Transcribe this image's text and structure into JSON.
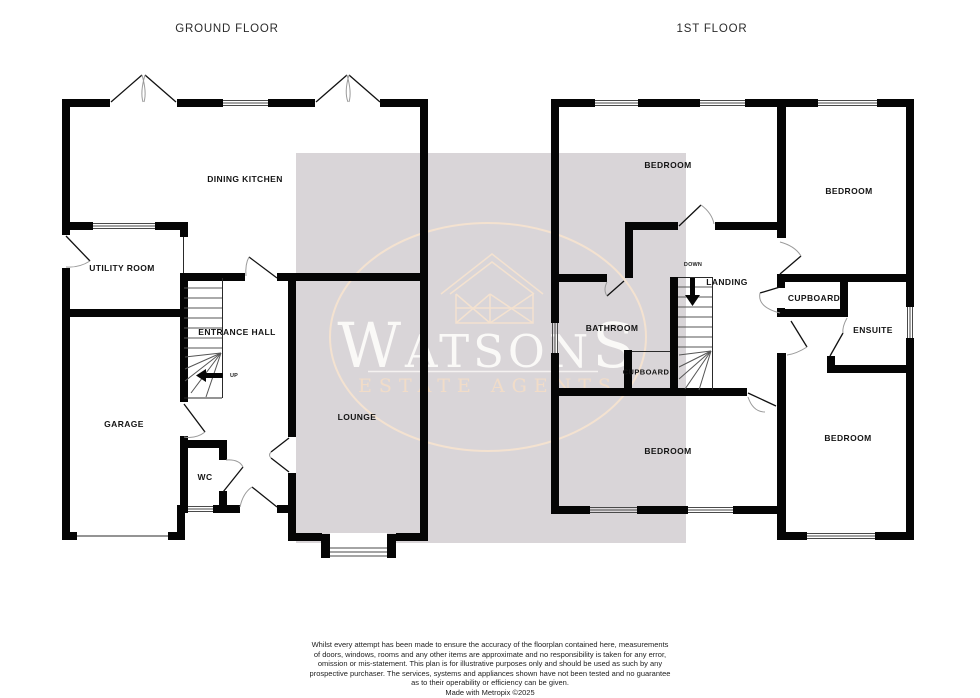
{
  "titles": {
    "ground_floor": "GROUND FLOOR",
    "first_floor": "1ST FLOOR"
  },
  "ground_floor": {
    "rooms": {
      "dining_kitchen": {
        "label": "DINING KITCHEN"
      },
      "utility_room": {
        "label": "UTILITY ROOM"
      },
      "entrance_hall": {
        "label": "ENTRANCE HALL"
      },
      "garage": {
        "label": "GARAGE"
      },
      "wc": {
        "label": "WC"
      },
      "lounge": {
        "label": "LOUNGE"
      }
    },
    "stairs": {
      "direction_label": "UP"
    }
  },
  "first_floor": {
    "rooms": {
      "bedroom_top_left": {
        "label": "BEDROOM"
      },
      "bedroom_top_right": {
        "label": "BEDROOM"
      },
      "bathroom": {
        "label": "BATHROOM"
      },
      "landing": {
        "label": "LANDING"
      },
      "cupboard_under_stairs": {
        "label": "CUPBOARD"
      },
      "cupboard": {
        "label": "CUPBOARD"
      },
      "ensuite": {
        "label": "ENSUITE"
      },
      "bedroom_bottom_left": {
        "label": "BEDROOM"
      },
      "bedroom_bottom_right": {
        "label": "BEDROOM"
      }
    },
    "stairs": {
      "direction_label": "DOWN"
    }
  },
  "watermark": {
    "name": "WATSONS",
    "tagline": "ESTATE AGENTS",
    "colors": {
      "panel": "#d9d5d8",
      "accent": "#f4e2d0",
      "text": "#fdfcfa"
    }
  },
  "disclaimer": {
    "lines": [
      "Whilst every attempt has been made to ensure the accuracy of the floorplan contained here, measurements",
      "of doors, windows, rooms and any other items are approximate and no responsibility is taken for any error,",
      "omission or mis-statement. This plan is for illustrative purposes only and should be used as such by any",
      "prospective purchaser. The services, systems and appliances shown have not been tested and no guarantee",
      "as to their operability or efficiency can be given.",
      "Made with Metropix ©2025"
    ]
  }
}
